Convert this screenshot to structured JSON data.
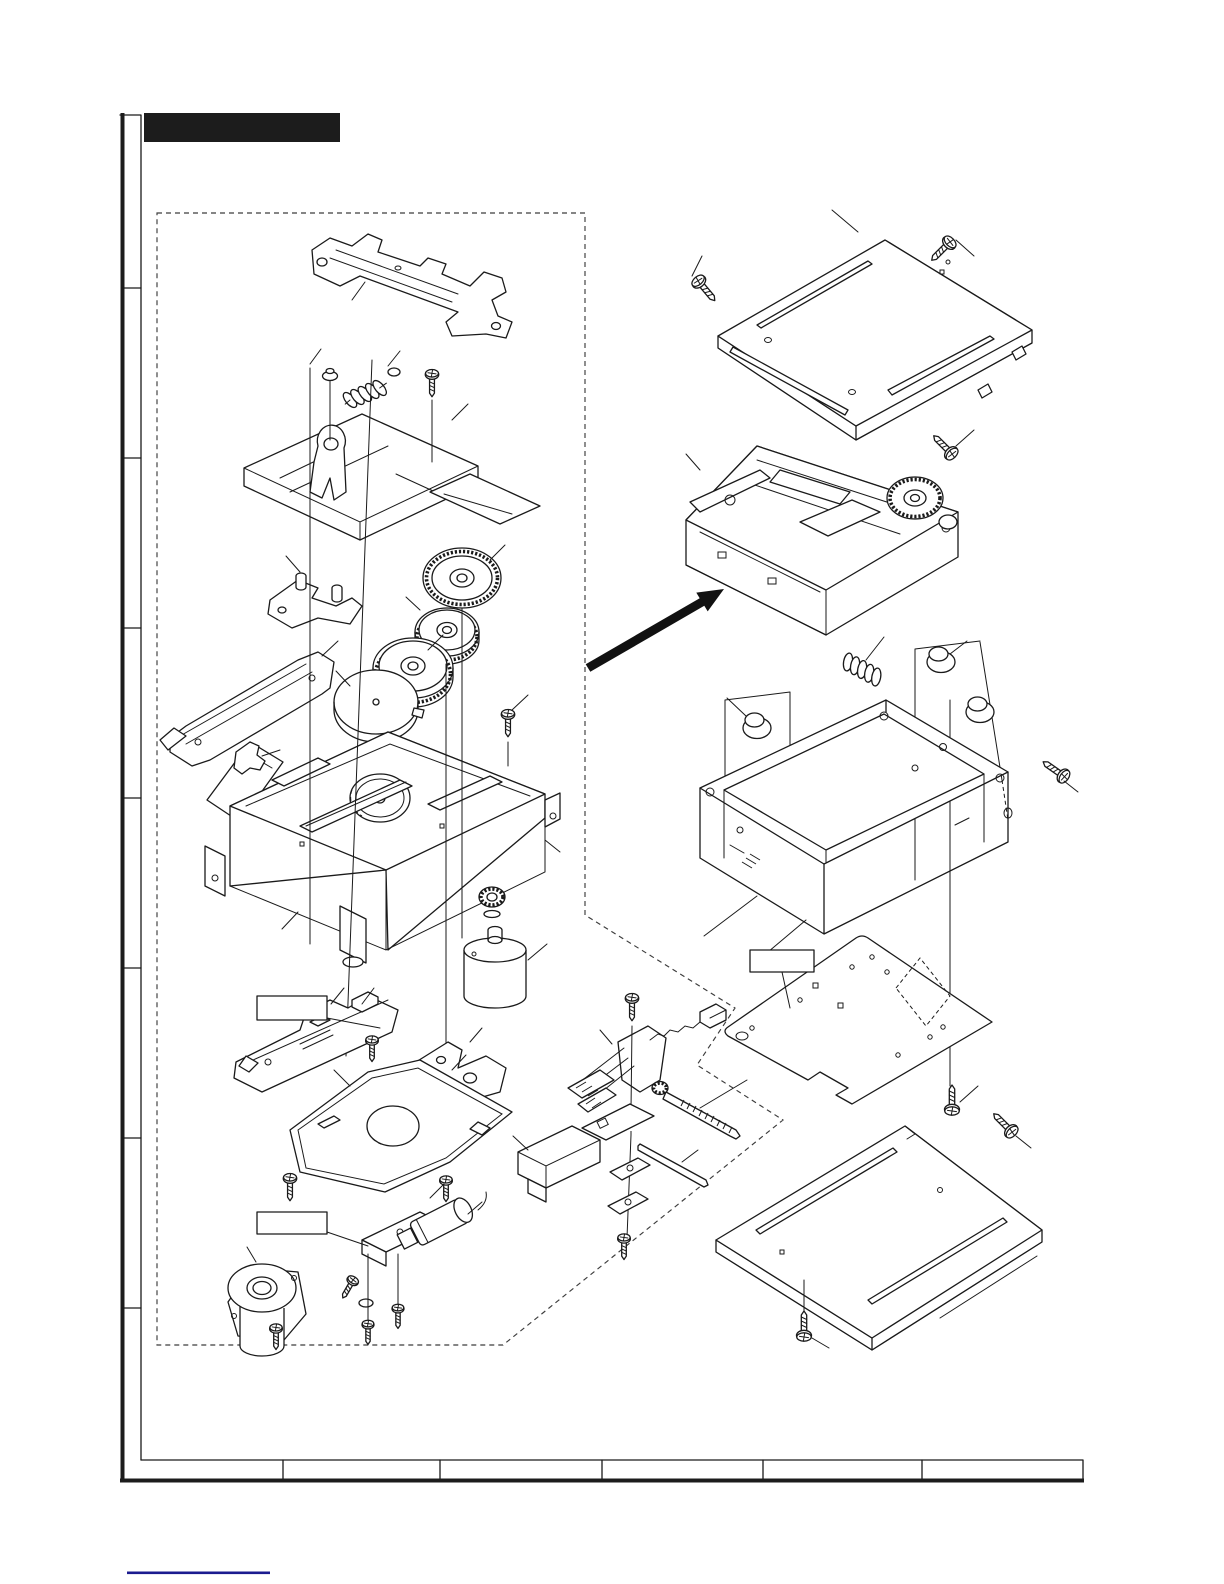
{
  "page": {
    "type": "exploded-parts-diagram",
    "background": "#ffffff",
    "ink_color": "#1a1a1a",
    "boundary_style": "dashed",
    "link_underline_color": "#1b1b8f"
  },
  "header": {
    "title_bar": {
      "text": "",
      "style": "redacted-black-bar",
      "color": "#1c1c1c"
    }
  },
  "margin_column": {
    "tick_count": 7
  },
  "callout_boxes": [
    {
      "id": "label-box-1",
      "text": ""
    },
    {
      "id": "label-box-2",
      "text": ""
    },
    {
      "id": "label-box-3",
      "text": ""
    }
  ],
  "footer": {
    "cells": [
      "",
      "",
      "",
      "",
      "",
      ""
    ],
    "link_text": ""
  },
  "parts": [
    "lift-bracket",
    "slide-chassis",
    "coil-spring",
    "guide-bracket",
    "disc-gear",
    "pulley-gear-1",
    "pulley-gear-2",
    "cam-disc",
    "slide-plate",
    "window-sheet",
    "wire-hook",
    "main-chassis",
    "spindle-gear",
    "spindle-motor",
    "switch-pcb-strip",
    "support-arm",
    "tray-plate",
    "solenoid-assembly",
    "flange-motor",
    "worm-lever",
    "connector-wire",
    "lead-screw",
    "guide-rod",
    "gearbox-block",
    "top-cover",
    "mechanism-unit",
    "assembly-arrow",
    "damper-spring",
    "damper-grommet",
    "mount-cage",
    "pcb-plate",
    "bottom-cover",
    "screw"
  ]
}
